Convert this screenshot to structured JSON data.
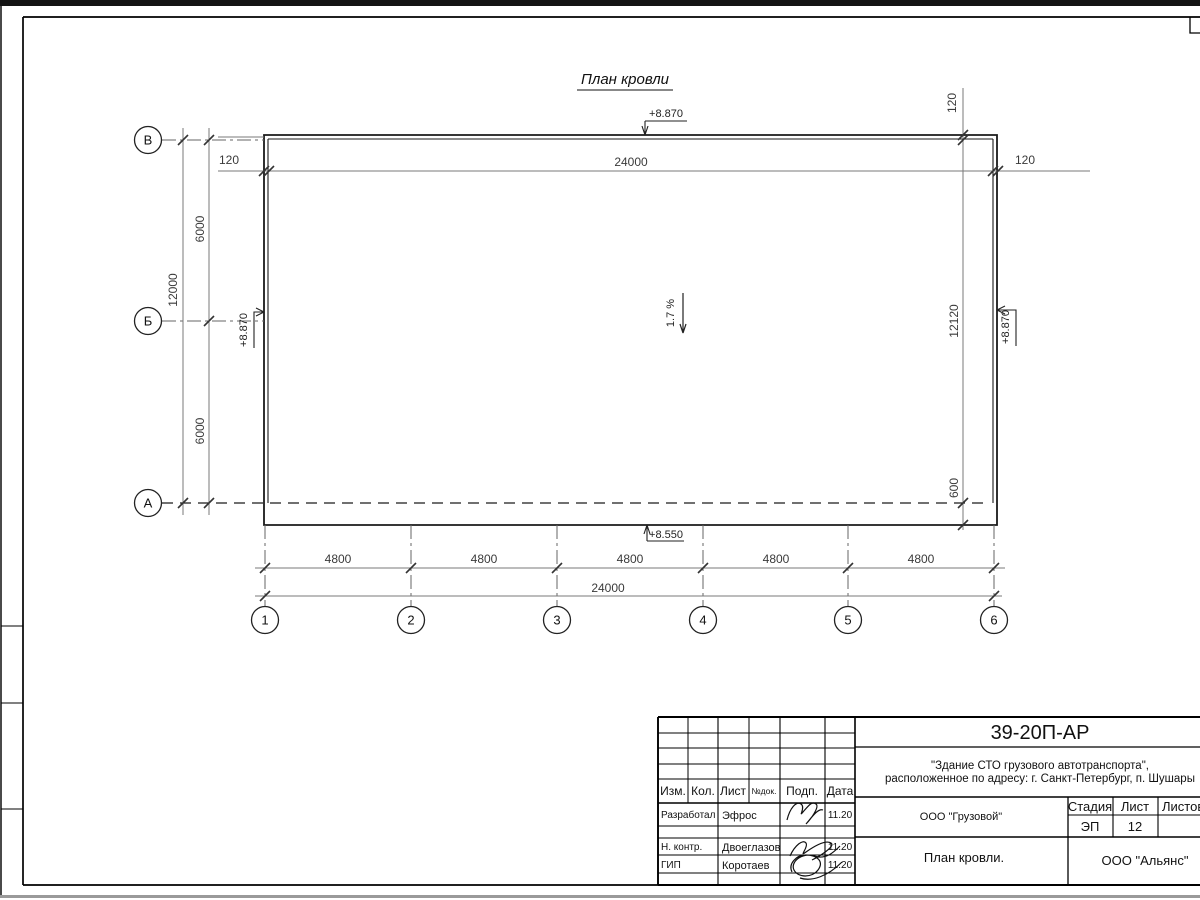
{
  "drawing": {
    "title": "План кровли",
    "slope": "1.7 %",
    "elevations": {
      "top": "+8.870",
      "left": "+8.870",
      "right": "+8.870",
      "bottom": "+8.550"
    },
    "dims": {
      "top_24000": "24000",
      "bottom_24000": "24000",
      "top_left_120": "120",
      "top_right_120": "120",
      "right_vert_120": "120",
      "right_12120": "12120",
      "right_600": "600",
      "left_12000": "12000",
      "left_6000_upper": "6000",
      "left_6000_lower": "6000",
      "bottom_4800": [
        "4800",
        "4800",
        "4800",
        "4800",
        "4800"
      ]
    },
    "axes": {
      "rows": [
        "В",
        "Б",
        "А"
      ],
      "cols": [
        "1",
        "2",
        "3",
        "4",
        "5",
        "6"
      ]
    }
  },
  "title_block": {
    "doc_number": "39-20П-АР",
    "project_line1": "\"Здание СТО грузового автотранспорта\",",
    "project_line2": "расположенное по адресу: г. Санкт-Петербург, п. Шушары",
    "header": {
      "izm": "Изм.",
      "kol": "Кол.",
      "list": "Лист",
      "ndok": "№док.",
      "podp": "Подп.",
      "data": "Дата"
    },
    "rows": [
      {
        "role": "Разработал",
        "name": "Эфрос",
        "date": "11.20"
      },
      {
        "role": "Н. контр.",
        "name": "Двоеглазов",
        "date": "11.20"
      },
      {
        "role": "ГИП",
        "name": "Коротаев",
        "date": "11.20"
      }
    ],
    "org": "ООО \"Грузовой\"",
    "stage_label": "Стадия",
    "sheet_label": "Лист",
    "sheets_label": "Листов",
    "stage_value": "ЭП",
    "sheet_value": "12",
    "drawing_title": "План кровли.",
    "company": "ООО \"Альянс\""
  }
}
